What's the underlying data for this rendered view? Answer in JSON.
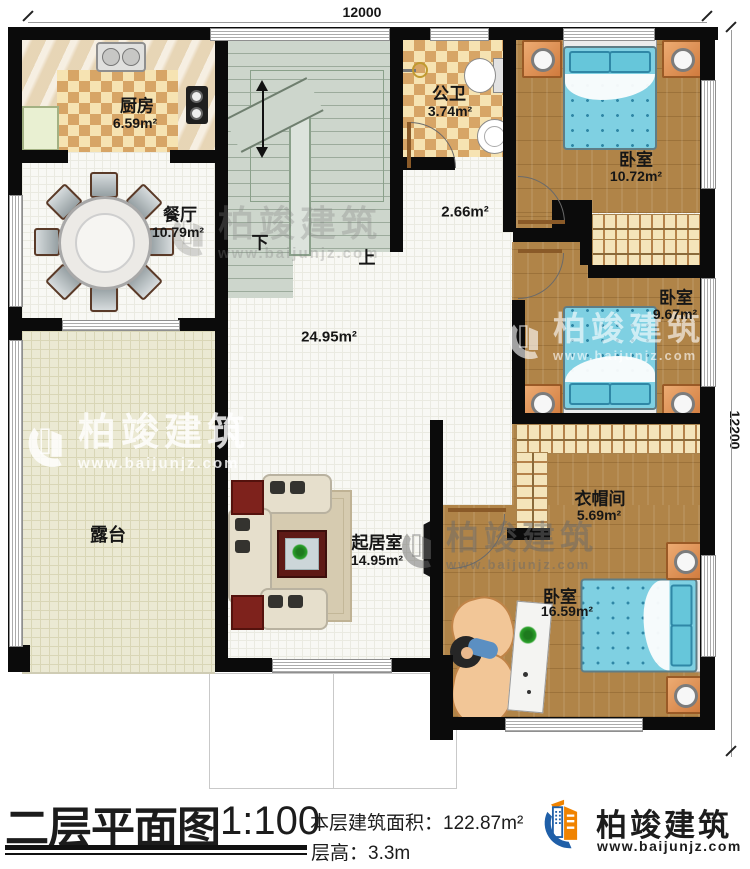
{
  "dimensions": {
    "top": "12000",
    "right": "12200"
  },
  "rooms": {
    "kitchen": {
      "name": "厨房",
      "area": "6.59m²"
    },
    "dining": {
      "name": "餐厅",
      "area": "10.79m²"
    },
    "public_bath": {
      "name": "公卫",
      "area": "3.74m²"
    },
    "bedroom_top": {
      "name": "卧室",
      "area": "10.72m²"
    },
    "hallway": {
      "area": "2.66m²"
    },
    "bedroom_mid": {
      "name": "卧室",
      "area": "9.67m²"
    },
    "open_area": {
      "area": "24.95m²"
    },
    "terrace": {
      "name": "露台"
    },
    "living": {
      "name": "起居室",
      "area": "14.95m²"
    },
    "cloakroom": {
      "name": "衣帽间",
      "area": "5.69m²"
    },
    "bedroom_bottom": {
      "name": "卧室",
      "area": "16.59m²"
    }
  },
  "stairs": {
    "down": "下",
    "up": "上"
  },
  "title_block": {
    "title": "二层平面图",
    "scale": "1:100",
    "area_label": "本层建筑面积：",
    "area_value": "122.87m²",
    "height_label": "层高：",
    "height_value": "3.3m"
  },
  "brand": {
    "name": "柏竣建筑",
    "site": "www.baijunjz.com"
  },
  "watermark": {
    "name": "柏竣建筑",
    "site": "www.baijunjz.com"
  },
  "colors": {
    "wall": "#0b0b0b",
    "wood": "#b08448",
    "bed_blue": "#7fd0e2",
    "accent_blue": "#1f5fa8",
    "accent_orange": "#f08300"
  }
}
